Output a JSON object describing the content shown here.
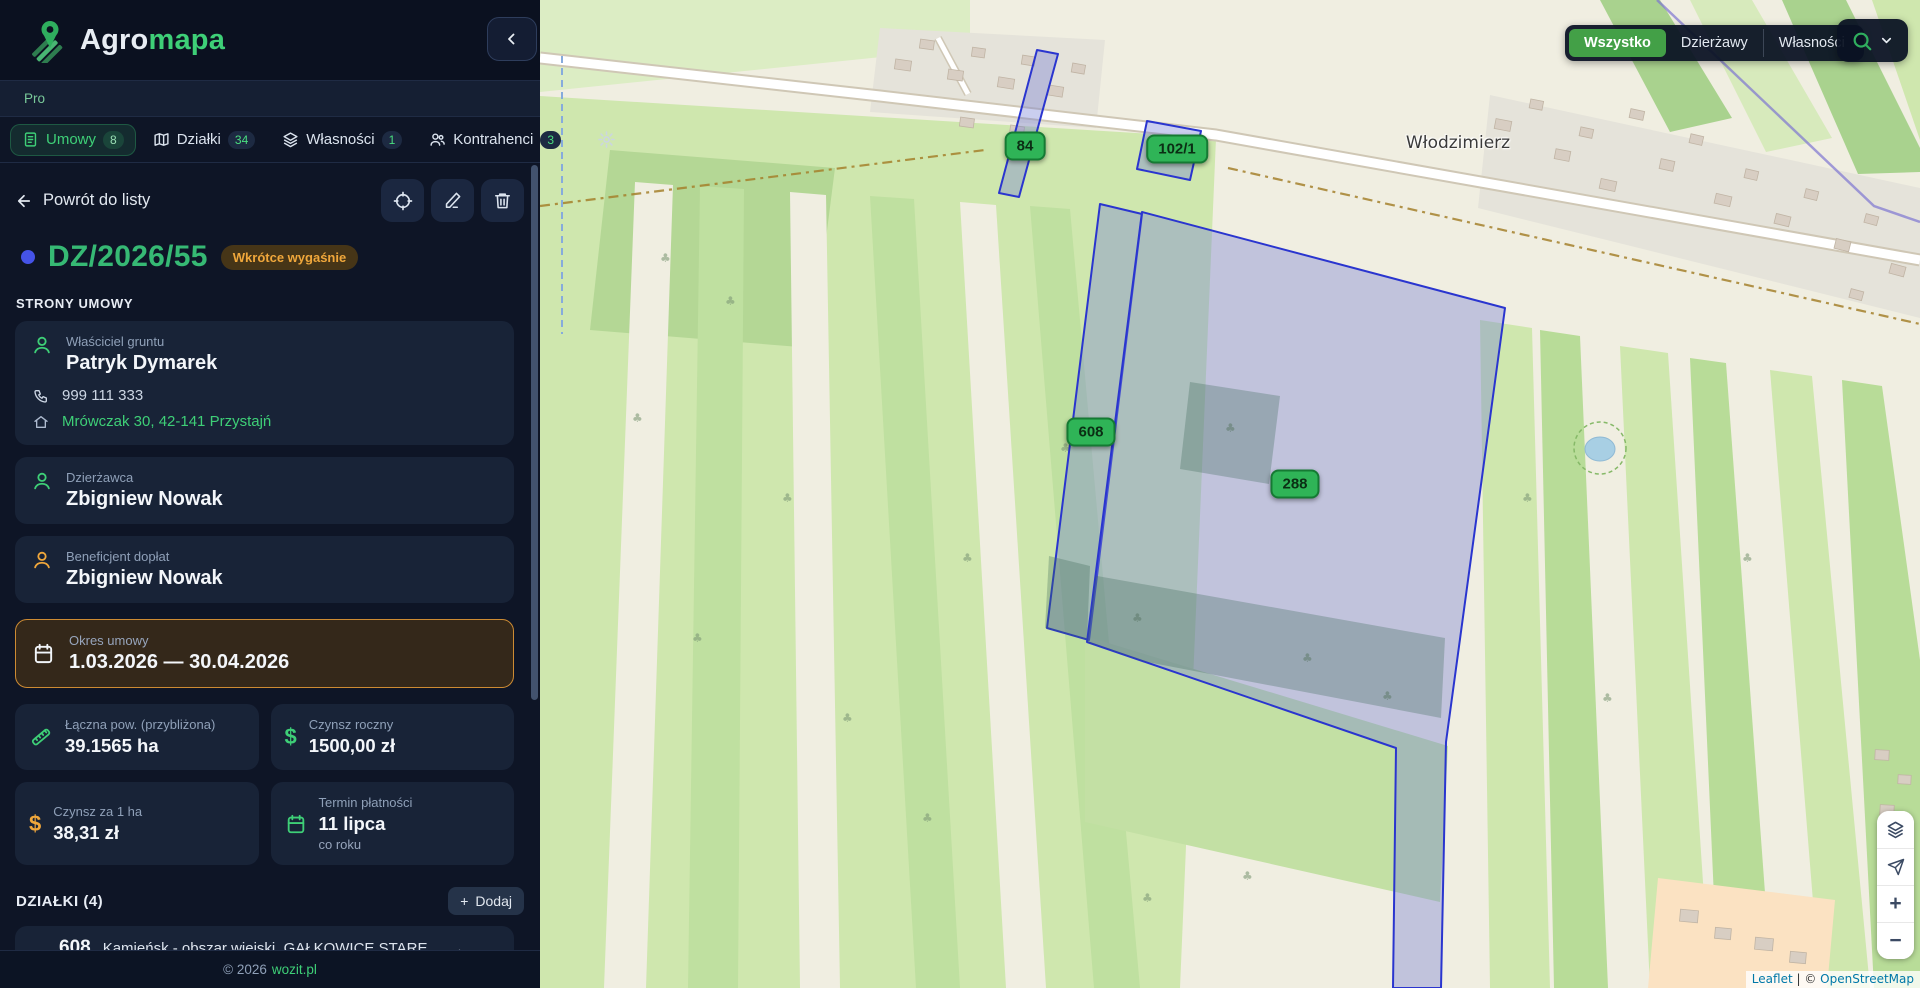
{
  "brand": {
    "name_primary": "Agro",
    "name_secondary": "mapa",
    "plan": "Pro"
  },
  "nav": {
    "tabs": [
      {
        "label": "Umowy",
        "badge": "8",
        "icon": "document-icon",
        "active": true
      },
      {
        "label": "Działki",
        "badge": "34",
        "icon": "map-icon",
        "active": false
      },
      {
        "label": "Własności",
        "badge": "1",
        "icon": "layers-icon",
        "active": false
      },
      {
        "label": "Kontrahenci",
        "badge": "3",
        "icon": "users-icon",
        "active": false
      }
    ],
    "settings_icon": "gear-icon"
  },
  "contract": {
    "back": "Powrót do listy",
    "number": "DZ/2026/55",
    "status": "Wkrótce wygaśnie",
    "parties_header": "STRONY UMOWY",
    "parties": [
      {
        "role": "Właściciel gruntu",
        "name": "Patryk Dymarek",
        "phone": "999 111 333",
        "address": "Mrówczak 30, 42-141 Przystajń"
      },
      {
        "role": "Dzierżawca",
        "name": "Zbigniew Nowak"
      },
      {
        "role": "Beneficjent dopłat",
        "name": "Zbigniew Nowak"
      }
    ],
    "period": {
      "label": "Okres umowy",
      "value": "1.03.2026 — 30.04.2026"
    },
    "stats": [
      {
        "label": "Łączna pow. (przybliżona)",
        "value": "39.1565 ha",
        "icon": "ruler-icon"
      },
      {
        "label": "Czynsz roczny",
        "value": "1500,00 zł",
        "icon": "dollar-icon"
      },
      {
        "label": "Czynsz za 1 ha",
        "value": "38,31 zł",
        "icon": "dollar-icon"
      },
      {
        "label": "Termin płatności",
        "value": "11 lipca",
        "note": "co roku",
        "icon": "calendar-icon"
      }
    ],
    "parcels_header": "DZIAŁKI (4)",
    "add_button": {
      "plus": "+",
      "label": "Dodaj"
    },
    "parcels": [
      {
        "number": "608",
        "location": "Kamieńsk - obszar wiejski, GAŁKOWICE STARE",
        "area": "~3.1314 ha"
      }
    ]
  },
  "footer": {
    "text": "© 2026",
    "link": "wozit.pl"
  },
  "map": {
    "filters": [
      {
        "label": "Wszystko",
        "active": true
      },
      {
        "label": "Dzierżawy",
        "active": false
      },
      {
        "label": "Własności",
        "active": false
      }
    ],
    "place": "Włodzimierz",
    "badges": [
      {
        "label": "84"
      },
      {
        "label": "102/1"
      },
      {
        "label": "608"
      },
      {
        "label": "288"
      }
    ],
    "controls": {
      "zoom_in": "+",
      "zoom_out": "−",
      "icons": [
        "layers-icon",
        "locate-arrow-icon"
      ]
    },
    "attribution": {
      "leaflet": "Leaflet",
      "divider": " | © ",
      "osm": "OpenStreetMap"
    }
  },
  "icons": {
    "dollar": "$"
  },
  "colors": {
    "accent_green": "#3ecf77",
    "map_badge_green": "#2fb457",
    "parcel_blue": "#2a35cf",
    "amber": "#f0a73b",
    "sidebar_bg": "#0e1526",
    "card_bg": "#182337"
  }
}
